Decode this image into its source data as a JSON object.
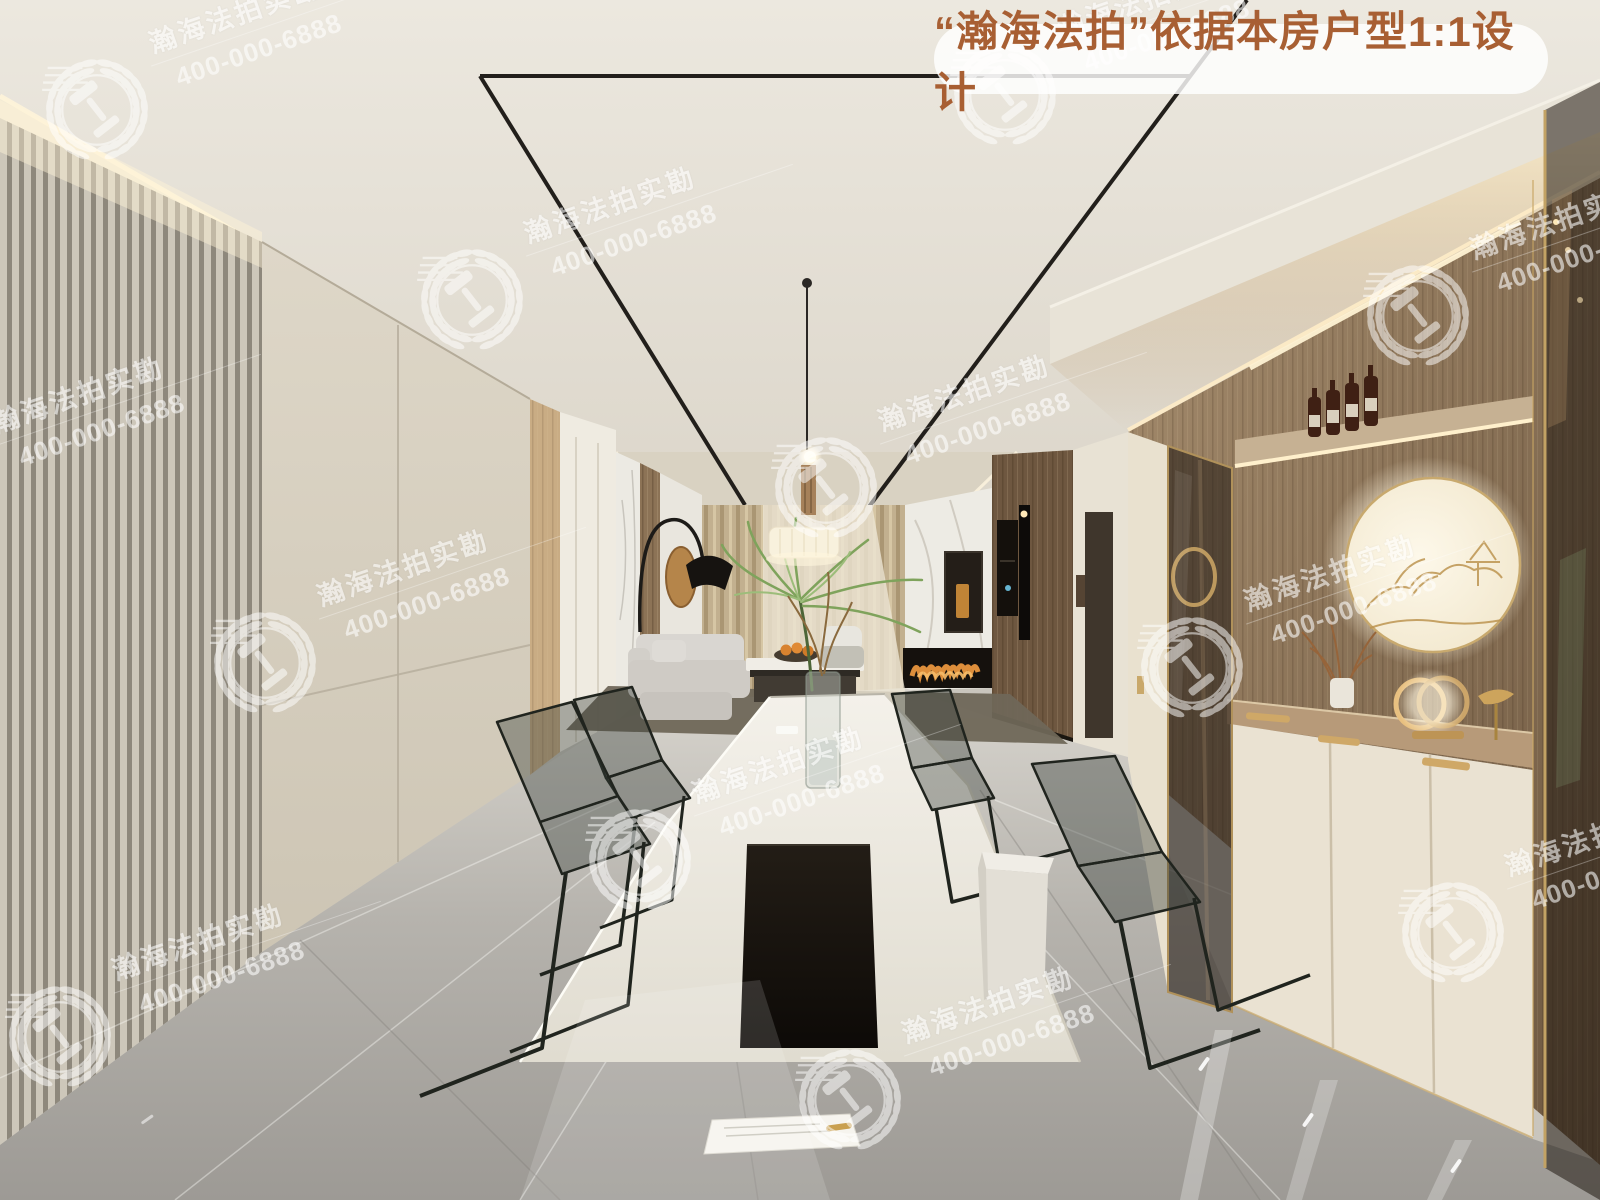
{
  "banner": {
    "text": "“瀚海法拍”依据本房户型1:1设计",
    "text_color": "#a85f33",
    "background": "rgba(255,255,255,0.82)"
  },
  "watermark": {
    "brand": "瀚海法拍实勘",
    "phone": "400-000-6888",
    "logo": "laurel-wreath-gavel-icon",
    "color": "#ffffff",
    "rotation_deg": -19,
    "positions": [
      [
        97,
        110
      ],
      [
        1005,
        95
      ],
      [
        472,
        300
      ],
      [
        1418,
        316
      ],
      [
        826,
        488
      ],
      [
        265,
        663
      ],
      [
        1192,
        668
      ],
      [
        640,
        860
      ],
      [
        1453,
        933
      ],
      [
        60,
        1037
      ],
      [
        850,
        1100
      ],
      [
        -60,
        490
      ]
    ]
  },
  "scene": {
    "description_colors": {
      "ceiling": "#e9e5dc",
      "left_slat_wall_light": "#cdc7ba",
      "left_slat_wall_dark": "#8e887c",
      "cream_cabinet": "#ddd6c7",
      "curtain": "#c2b08f",
      "wood_cabinet": "#8a7156",
      "accent_gold": "#c9a86a",
      "marble_floor": "#b3b0aa",
      "track_line": "#221f1b",
      "fireplace_flame": "#e8963e",
      "table_top": "#f0ede5",
      "table_base": "#17130f",
      "glass_chair": "rgba(52,60,54,0.38)"
    }
  }
}
